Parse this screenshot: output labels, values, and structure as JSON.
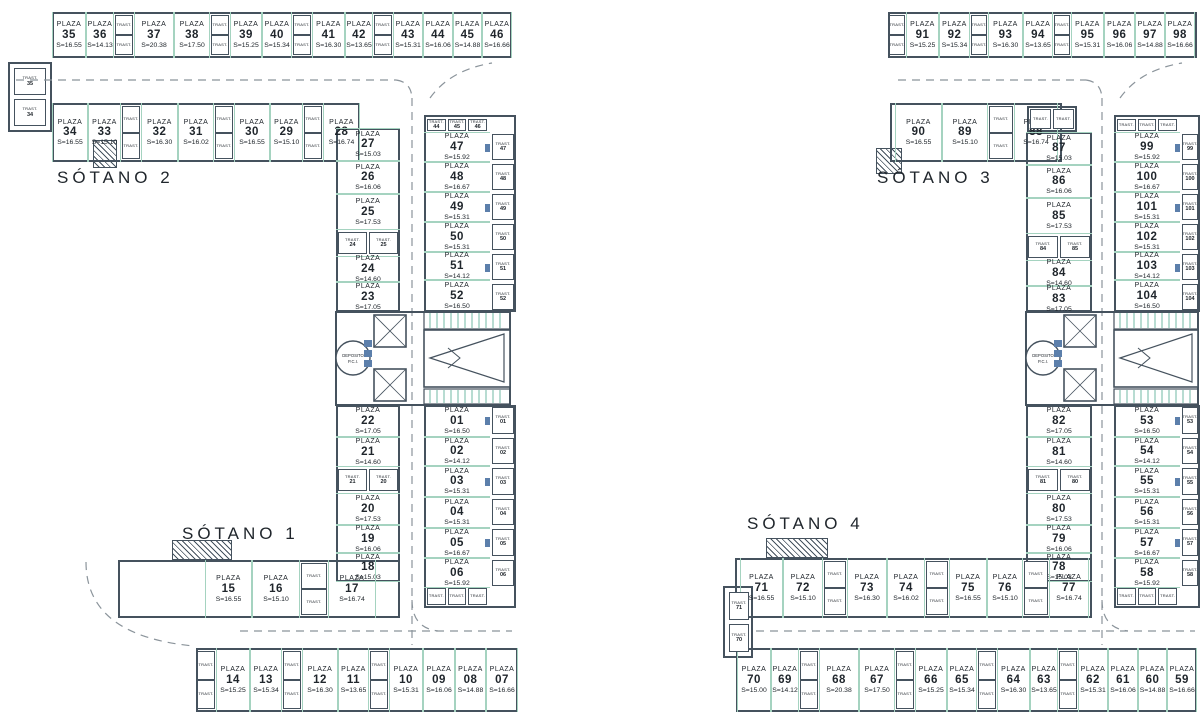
{
  "colors": {
    "wall": "#45525e",
    "divider": "#a5d3c0",
    "text": "#20262c",
    "dash": "#8b949b",
    "door": "#5c7fab",
    "teal_dark": "#63b39c"
  },
  "labels": {
    "plaza": "PLAZA",
    "trast": "TRAST.",
    "deposit_line1": "DEPOSITO",
    "deposit_line2": "P.C.I."
  },
  "plans": [
    {
      "floor_label_upper": "SÓTANO 2",
      "floor_label_lower": "SÓTANO 1",
      "rows": {
        "top": [
          {
            "num": "35",
            "s": "S=16.55"
          },
          {
            "num": "36",
            "s": "S=14.13"
          },
          {
            "num": "37",
            "s": "S=20.38"
          },
          {
            "num": "38",
            "s": "S=17.50"
          },
          {
            "num": "39",
            "s": "S=15.25"
          },
          {
            "num": "40",
            "s": "S=15.34"
          },
          {
            "num": "41",
            "s": "S=16.30"
          },
          {
            "num": "42",
            "s": "S=13.65"
          },
          {
            "num": "43",
            "s": "S=15.31"
          },
          {
            "num": "44",
            "s": "S=16.06"
          },
          {
            "num": "45",
            "s": "S=14.88"
          },
          {
            "num": "46",
            "s": "S=16.66"
          }
        ],
        "second": [
          {
            "num": "34",
            "s": "S=16.55"
          },
          {
            "num": "33",
            "s": "S=15.10"
          },
          {
            "num": "32",
            "s": "S=16.30"
          },
          {
            "num": "31",
            "s": "S=16.02"
          },
          {
            "num": "30",
            "s": "S=16.55"
          },
          {
            "num": "29",
            "s": "S=15.10"
          },
          {
            "num": "28",
            "s": "S=16.74"
          }
        ],
        "col_upper_left": [
          {
            "num": "27",
            "s": "S=15.03"
          },
          {
            "num": "26",
            "s": "S=16.06"
          },
          {
            "num": "25",
            "s": "S=17.53"
          },
          {
            "num": "24",
            "s": "S=14.60"
          },
          {
            "num": "23",
            "s": "S=17.05"
          }
        ],
        "col_upper_right": [
          {
            "num": "47",
            "s": "S=15.92"
          },
          {
            "num": "48",
            "s": "S=16.67"
          },
          {
            "num": "49",
            "s": "S=15.31"
          },
          {
            "num": "50",
            "s": "S=15.31"
          },
          {
            "num": "51",
            "s": "S=14.12"
          },
          {
            "num": "52",
            "s": "S=16.50"
          }
        ],
        "col_lower_left": [
          {
            "num": "22",
            "s": "S=17.05"
          },
          {
            "num": "21",
            "s": "S=14.60"
          },
          {
            "num": "20",
            "s": "S=17.53"
          },
          {
            "num": "19",
            "s": "S=16.06"
          },
          {
            "num": "18",
            "s": "S=15.03"
          }
        ],
        "col_lower_right": [
          {
            "num": "01",
            "s": "S=16.50"
          },
          {
            "num": "02",
            "s": "S=14.12"
          },
          {
            "num": "03",
            "s": "S=15.31"
          },
          {
            "num": "04",
            "s": "S=15.31"
          },
          {
            "num": "05",
            "s": "S=16.67"
          },
          {
            "num": "06",
            "s": "S=15.92"
          }
        ],
        "third": [
          {
            "num": "15",
            "s": "S=16.55"
          },
          {
            "num": "16",
            "s": "S=15.10"
          },
          {
            "num": "17",
            "s": "S=16.74"
          }
        ],
        "bottom": [
          {
            "num": "14",
            "s": "S=15.25"
          },
          {
            "num": "13",
            "s": "S=15.34"
          },
          {
            "num": "12",
            "s": "S=16.30"
          },
          {
            "num": "11",
            "s": "S=13.65"
          },
          {
            "num": "10",
            "s": "S=15.31"
          },
          {
            "num": "09",
            "s": "S=16.06"
          },
          {
            "num": "08",
            "s": "S=14.88"
          },
          {
            "num": "07",
            "s": "S=16.66"
          }
        ]
      },
      "trast": {
        "upper_right_col": [
          "47",
          "48",
          "49",
          "50",
          "51",
          "52"
        ],
        "lower_right_col": [
          "01",
          "02",
          "03",
          "04",
          "05",
          "06"
        ],
        "top_right_row": [
          "44",
          "45",
          "46"
        ],
        "upper_pair": [
          "24",
          "25"
        ],
        "lower_pair": [
          "21",
          "20"
        ],
        "edge_pair": [
          "35",
          "34"
        ]
      }
    },
    {
      "floor_label_upper": "SÓTANO 3",
      "floor_label_lower": "SÓTANO 4",
      "rows": {
        "top": [
          {
            "num": "91",
            "s": "S=15.25"
          },
          {
            "num": "92",
            "s": "S=15.34"
          },
          {
            "num": "93",
            "s": "S=16.30"
          },
          {
            "num": "94",
            "s": "S=13.65"
          },
          {
            "num": "95",
            "s": "S=15.31"
          },
          {
            "num": "96",
            "s": "S=16.06"
          },
          {
            "num": "97",
            "s": "S=14.88"
          },
          {
            "num": "98",
            "s": "S=16.66"
          }
        ],
        "second": [
          {
            "num": "90",
            "s": "S=16.55"
          },
          {
            "num": "89",
            "s": "S=15.10"
          },
          {
            "num": "88",
            "s": "S=16.74"
          }
        ],
        "col_upper_left": [
          {
            "num": "87",
            "s": "S=15.03"
          },
          {
            "num": "86",
            "s": "S=16.06"
          },
          {
            "num": "85",
            "s": "S=17.53"
          },
          {
            "num": "84",
            "s": "S=14.60"
          },
          {
            "num": "83",
            "s": "S=17.05"
          }
        ],
        "col_upper_right": [
          {
            "num": "99",
            "s": "S=15.92"
          },
          {
            "num": "100",
            "s": "S=16.67"
          },
          {
            "num": "101",
            "s": "S=15.31"
          },
          {
            "num": "102",
            "s": "S=15.31"
          },
          {
            "num": "103",
            "s": "S=14.12"
          },
          {
            "num": "104",
            "s": "S=16.50"
          }
        ],
        "col_lower_left": [
          {
            "num": "82",
            "s": "S=17.05"
          },
          {
            "num": "81",
            "s": "S=14.60"
          },
          {
            "num": "80",
            "s": "S=17.53"
          },
          {
            "num": "79",
            "s": "S=16.06"
          },
          {
            "num": "78",
            "s": "S=15.03"
          }
        ],
        "col_lower_right": [
          {
            "num": "53",
            "s": "S=16.50"
          },
          {
            "num": "54",
            "s": "S=14.12"
          },
          {
            "num": "55",
            "s": "S=15.31"
          },
          {
            "num": "56",
            "s": "S=15.31"
          },
          {
            "num": "57",
            "s": "S=16.67"
          },
          {
            "num": "58",
            "s": "S=15.92"
          }
        ],
        "third": [
          {
            "num": "71",
            "s": "S=16.55"
          },
          {
            "num": "72",
            "s": "S=15.10"
          },
          {
            "num": "73",
            "s": "S=16.30"
          },
          {
            "num": "74",
            "s": "S=16.02"
          },
          {
            "num": "75",
            "s": "S=16.55"
          },
          {
            "num": "76",
            "s": "S=15.10"
          },
          {
            "num": "77",
            "s": "S=16.74"
          }
        ],
        "bottom": [
          {
            "num": "70",
            "s": "S=15.00"
          },
          {
            "num": "69",
            "s": "S=14.12"
          },
          {
            "num": "68",
            "s": "S=20.38"
          },
          {
            "num": "67",
            "s": "S=17.50"
          },
          {
            "num": "66",
            "s": "S=15.25"
          },
          {
            "num": "65",
            "s": "S=15.34"
          },
          {
            "num": "64",
            "s": "S=16.30"
          },
          {
            "num": "63",
            "s": "S=13.65"
          },
          {
            "num": "62",
            "s": "S=15.31"
          },
          {
            "num": "61",
            "s": "S=16.06"
          },
          {
            "num": "60",
            "s": "S=14.88"
          },
          {
            "num": "59",
            "s": "S=16.66"
          }
        ]
      },
      "trast": {
        "upper_right_col": [
          "99",
          "100",
          "101",
          "102",
          "103",
          "104"
        ],
        "lower_right_col": [
          "53",
          "54",
          "55",
          "56",
          "57",
          "58"
        ],
        "upper_pair": [
          "84",
          "85"
        ],
        "lower_pair": [
          "81",
          "80"
        ],
        "edge_pair": [
          "71",
          "70"
        ]
      }
    }
  ]
}
